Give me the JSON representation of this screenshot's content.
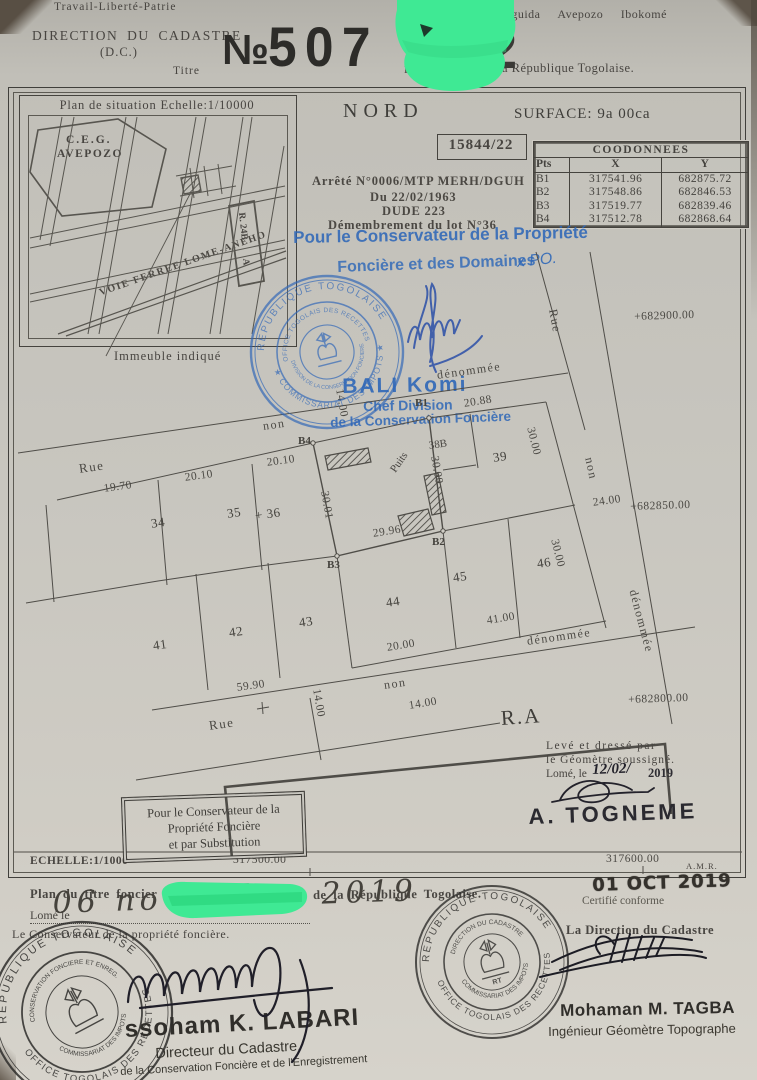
{
  "header": {
    "motto": "Travail-Liberté-Patrie",
    "localities": "Baguida Avepozo Ibokomé",
    "office": "DIRECTION DU CADASTRE",
    "office_abbr": "(D.C.)",
    "titre_label": "Titre",
    "livre_label": "Liv",
    "republic_line": "la République Togolaise.",
    "number_prefix": "№",
    "number_digits": "507",
    "number_digit_partial": "2"
  },
  "situation_map": {
    "title": "Plan de situation Echelle:1/10000",
    "ceg_line1": "C.E.G.",
    "ceg_line2": "AVEPOZO",
    "railway": "VOIE FERREE LOME-ANEHO",
    "road_ref": "R. 24B",
    "road_ref_a": "A",
    "callout": "Immeuble indiqué"
  },
  "title_block": {
    "north": "NORD",
    "surface": "SURFACE: 9a 00ca",
    "file_number": "15844/22"
  },
  "coordinates_table": {
    "title": "COODONNEES",
    "columns": [
      "Pts",
      "X",
      "Y"
    ],
    "rows": [
      [
        "B1",
        "317541.96",
        "682875.72"
      ],
      [
        "B2",
        "317548.86",
        "682846.53"
      ],
      [
        "B3",
        "317519.77",
        "682839.46"
      ],
      [
        "B4",
        "317512.78",
        "682868.64"
      ]
    ]
  },
  "decree": {
    "line1": "Arrêté N°0006/MTP MERH/DGUH",
    "line2": "Du 22/02/1963",
    "line3": "DUDE 223",
    "line4": "Démembrement du lot N°36"
  },
  "conservator_overlay": {
    "line1": "Pour le Conservateur de la Propriété",
    "line2": "Foncière et des Domaines",
    "annotation": "x PO.",
    "officer_name": "BALI Komi",
    "officer_title1": "Chef Division",
    "officer_title2": "de la Conservation Foncière"
  },
  "plan": {
    "rue": "Rue",
    "non": "non",
    "denommee": "dénommée",
    "puits": "Puits",
    "ra": "R.A",
    "lot_34": "34",
    "lot_35": "35",
    "lot_36": "+ 36",
    "lot_38b": "38B",
    "lot_39": "39",
    "lot_41": "41",
    "lot_42": "42",
    "lot_43": "43",
    "lot_44": "44",
    "lot_45": "45",
    "lot_46": "46",
    "b1": "B1",
    "b2": "B2",
    "b3": "B3",
    "b4": "B4",
    "m_19_70": "19.70",
    "m_20_10": "20.10",
    "m_20_88": "20.88",
    "m_30_01": "30.01",
    "m_30_00": "30.00",
    "m_29_96": "29.96",
    "m_24_00": "24.00",
    "m_41_00": "41.00",
    "m_20_00": "20.00",
    "m_59_90": "59.90",
    "m_14_00": "14.00",
    "ref_682900": "+682900.00",
    "ref_682850": "+682850.00",
    "ref_682800": "+682800.00",
    "ref_317500": "317500.00",
    "ref_317600": "317600.00",
    "amr": "A.M.R.",
    "scale": "ECHELLE:1/1000"
  },
  "substitution_box": {
    "line1": "Pour le Conservateur de la",
    "line2": "Propriété Foncière",
    "line3": "et par Substitution"
  },
  "surveyor": {
    "line1": "Levé et dressé par",
    "line2": "le Géomètre soussigné.",
    "line3_prefix": "Lomé, le",
    "date_hw": "12/02/",
    "year": "2019",
    "name": "A. TOGNEME"
  },
  "certification": {
    "certified": "Certifié conforme",
    "date_stamp": "01 OCT 2019"
  },
  "footer": {
    "plan_title_prefix": "Plan du titre foncier",
    "plan_title_suffix": "de la République Togolaise.",
    "lome_le": "Lomé le",
    "date_hw": "06 novembre 2019",
    "left_role": "Le Conservateur de la propriété foncière.",
    "right_role": "La Direction du Cadastre",
    "left_name": "ssoham K. LABARI",
    "left_title1": "Directeur du Cadastre,",
    "left_title2": "de la Conservation Foncière et de l'Enregistrement",
    "right_name": "Mohaman M. TAGBA",
    "right_title": "Ingénieur Géomètre Topographe"
  },
  "stamps": {
    "blue": {
      "ring_top": "REPUBLIQUE TOGOLAISE",
      "ring_bottom": "★ COMMISSARIAT DES IMPOTS ★",
      "inner_top": "OFFICE TOGOLAIS DES RECETTES",
      "inner_bottom": "DIVISION DE LA CONSERVATION FONCIERE"
    },
    "black_center": {
      "ring_top": "REPUBLIQUE TOGOLAISE",
      "ring_bottom": "★ OFFICE TOGOLAIS DES RECETTES ★",
      "inner_top": "DIRECTION DU CADASTRE",
      "inner_bottom": "COMMISSARIAT DES IMPOTS",
      "monogram": "RT"
    },
    "black_left": {
      "ring_top": "REPUBLIQUE TOGOLAISE",
      "ring_bottom": "★ OFFICE TOGOLAIS DES RECETTES ★",
      "inner_top": "CONSERVATION FONCIERE ET ENREG.",
      "inner_bottom": "COMMISSARIAT DES IMPOTS"
    }
  }
}
